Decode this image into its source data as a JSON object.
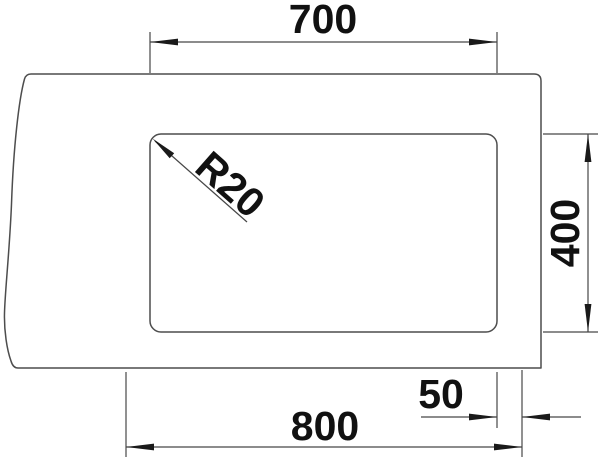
{
  "drawing": {
    "type": "technical-dimension-drawing",
    "subject": "sink-cutout-plan-view",
    "background_color": "#ffffff",
    "line_color": "#4d4d4d",
    "dimension_line_color": "#474747",
    "text_color": "#111111",
    "dimensions": {
      "cutout_width": {
        "value": "700",
        "orientation": "horizontal",
        "position": "top"
      },
      "cutout_height": {
        "value": "400",
        "orientation": "vertical",
        "position": "right"
      },
      "overall_width": {
        "value": "800",
        "orientation": "horizontal",
        "position": "bottom"
      },
      "edge_offset": {
        "value": "50",
        "orientation": "horizontal",
        "position": "bottom-right"
      },
      "corner_radius": {
        "value": "R20",
        "orientation": "diagonal-45deg",
        "position": "cutout-top-left-corner"
      }
    }
  }
}
